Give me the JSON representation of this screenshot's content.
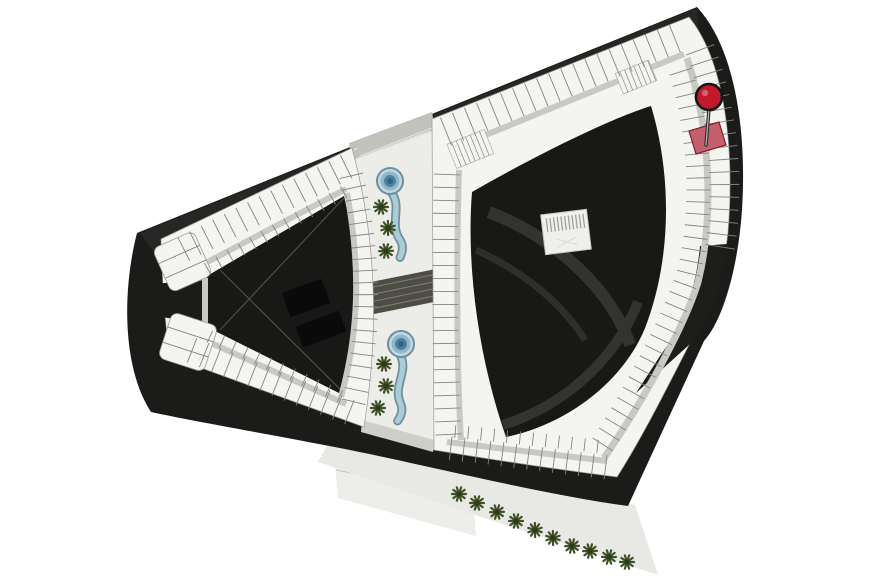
{
  "plan": {
    "marker": {
      "icon": "map-pin-icon",
      "x": 709,
      "y": 97,
      "color": "#c2192a",
      "outline": "#141414"
    },
    "selected_unit": {
      "points": "689,131 719,122 726,145 696,154",
      "fill": "#c2616d",
      "stroke": "#8a1b26"
    },
    "colors": {
      "background": "#ffffff",
      "site": "#1b1b19",
      "site_light": "#2e2e2c",
      "units": "#f4f4f1",
      "unit_line": "#85857f",
      "band_edge": "#9c9c96",
      "corridor": "#c9c9c4",
      "courtyard": "#181816",
      "courtyard_arc": "#34342f",
      "strip": "#ecece9",
      "walkway_dark": "#4d4d45",
      "walkway_hatch": "#7e7e74",
      "paving": "#c2c2bc",
      "plaza": "#ededea",
      "sidewalk": "#e8e8e4",
      "pool_rim": "#6e909e",
      "pool_water": "#8fb6c9",
      "pool_deep": "#4e81a0",
      "pool_center": "#33637f",
      "tree": "#3f5126",
      "tree_dark": "#2c3b18"
    },
    "landscape": {
      "pools": [
        {
          "x": 390,
          "y": 181,
          "rot": -6
        },
        {
          "x": 401,
          "y": 344,
          "rot": 4
        }
      ],
      "strip_trees": [
        [
          381,
          207
        ],
        [
          388,
          228
        ],
        [
          386,
          251
        ],
        [
          384,
          364
        ],
        [
          386,
          386
        ],
        [
          378,
          408
        ]
      ],
      "sidewalk_trees": [
        [
          459,
          494
        ],
        [
          477,
          503
        ],
        [
          497,
          512
        ],
        [
          516,
          521
        ],
        [
          535,
          530
        ],
        [
          553,
          538
        ],
        [
          572,
          546
        ],
        [
          590,
          551
        ],
        [
          609,
          557
        ],
        [
          627,
          562
        ]
      ]
    }
  }
}
